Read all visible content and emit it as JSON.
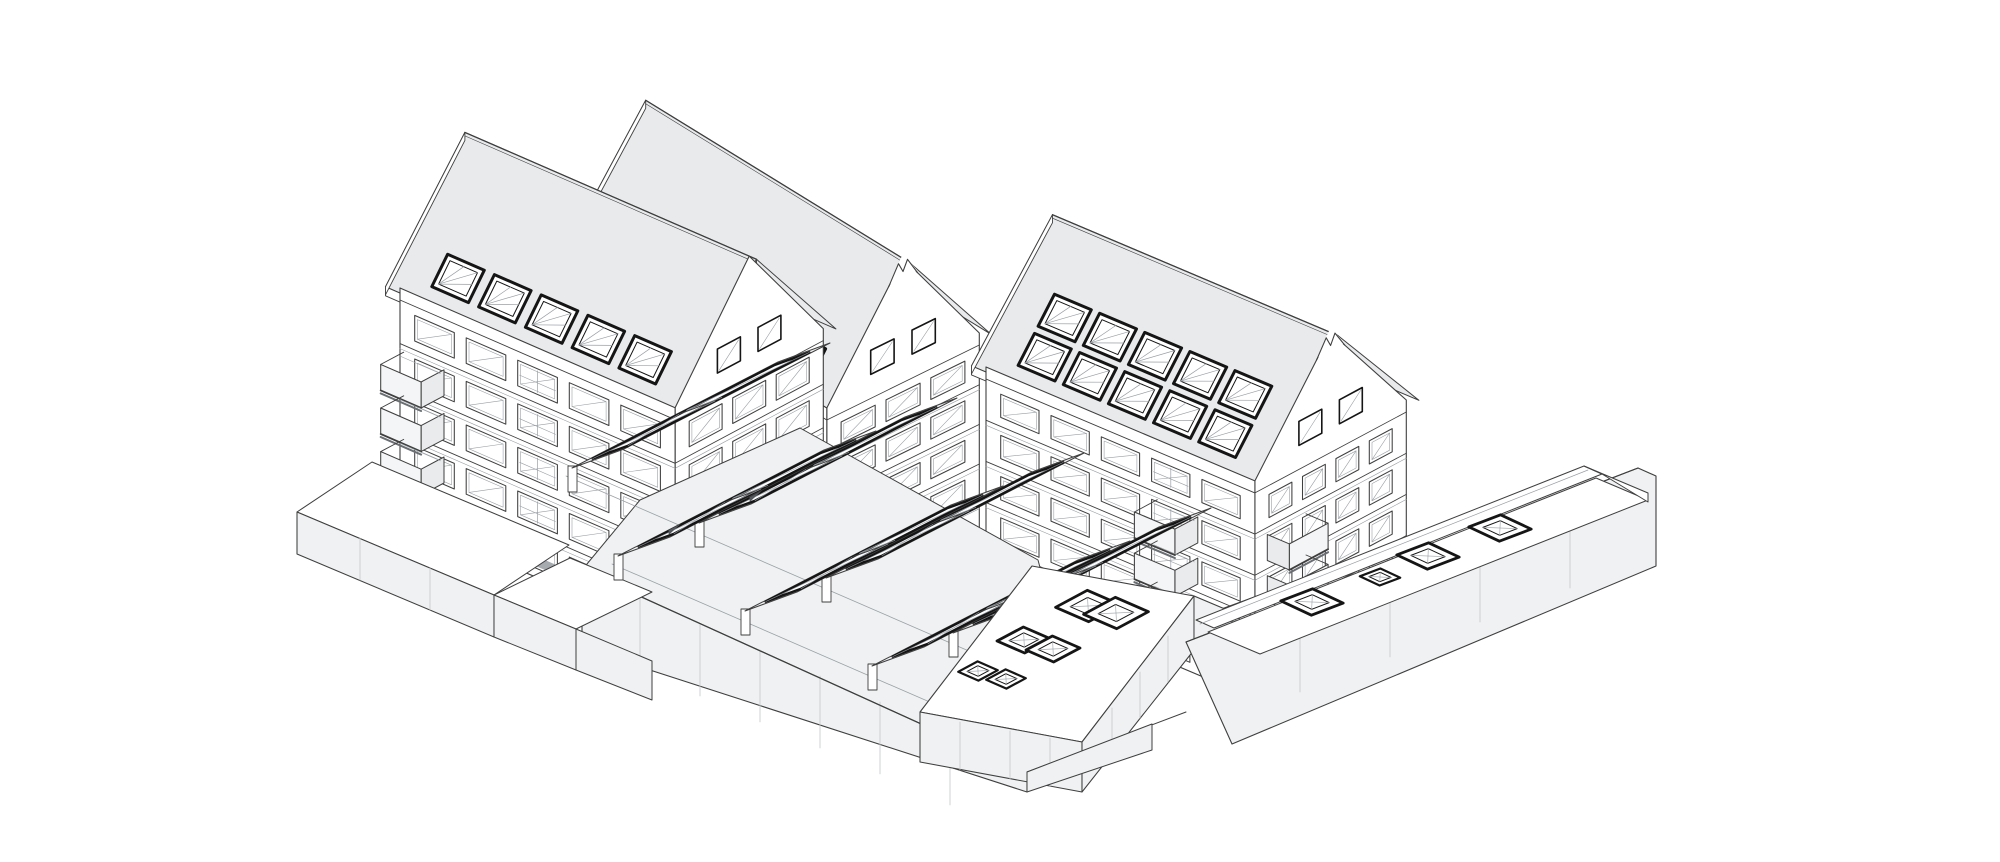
{
  "scene": {
    "type": "axonometric-architecture-illustration",
    "description": "Black-and-white axonometric line drawing of a residential ensemble: three gabled apartment buildings with roof windows and balconies arranged around a sunken courtyard covered by two rows of large tilted skylight glazing panels, with stepped podium terraces, a skylit courtyard roof deck and a low flat-roofed annex wing with rooflights.",
    "background": "#ffffff",
    "colors": {
      "line": "#3f3f3f",
      "line_dark": "#151515",
      "line_light": "#9aa0a5",
      "joint": "#c3c7ca",
      "roof_fill": "#e8eaec",
      "wall_fill": "#ffffff",
      "podium_fill": "#eff1f2",
      "panel_frame_fill": "#f2f3f5",
      "balcony_front": "#f4f5f6",
      "balcony_side": "#e9ebed",
      "dark_opening": "#a6abb0"
    },
    "buildings": [
      {
        "id": "building-left",
        "roof": "gable",
        "floors": 5,
        "front_window_columns": 5,
        "side_window_columns": 3,
        "roof_windows": 5,
        "balconies": 3
      },
      {
        "id": "building-middle",
        "roof": "gable-notched",
        "floors": 6,
        "front_window_columns": 5,
        "side_window_columns": 3,
        "roof_windows": 5,
        "balconies": 8
      },
      {
        "id": "building-right",
        "roof": "gable-notched",
        "floors": 5,
        "front_window_columns": 5,
        "side_window_columns": 4,
        "roof_windows": 10,
        "balconies": 7
      }
    ],
    "courtyard": {
      "tilted_glazing_panels": 8,
      "glazing_rows": 2,
      "deck_skylights": 6,
      "slope_arrows": 3
    },
    "annex_wing": {
      "skylights": 4,
      "parapet": true
    },
    "podium": {
      "terraces": 2,
      "stepped_retaining_walls": true
    }
  }
}
